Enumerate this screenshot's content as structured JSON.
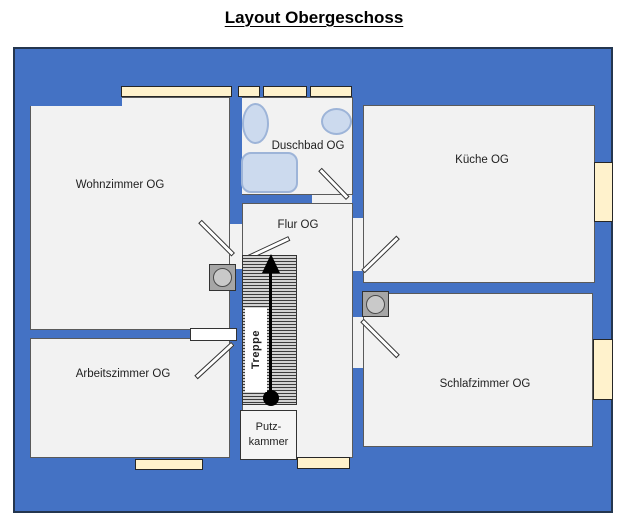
{
  "title": "Layout Obergeschoss",
  "rooms": {
    "wohnzimmer": {
      "label": "Wohnzimmer OG"
    },
    "duschbad": {
      "label": "Duschbad OG"
    },
    "kueche": {
      "label": "Küche OG"
    },
    "flur": {
      "label": "Flur OG"
    },
    "arbeitszimmer": {
      "label": "Arbeitszimmer OG"
    },
    "schlafzimmer": {
      "label": "Schlafzimmer OG"
    },
    "treppe": {
      "label": "Treppe"
    },
    "putzkammer": {
      "label": "Putz-\nkammer"
    }
  },
  "icons": {
    "stairs_direction": "up-arrow-icon",
    "columns": "chimney-column-icon",
    "doors": "door-leaf-icon",
    "windows": "window-icon"
  },
  "colors": {
    "blue": "#4472C4",
    "wall_border": "#24364F",
    "floor": "#F2F2F2",
    "floor_border": "#5A5A5A",
    "window_fill": "#FFF2CC",
    "window_border": "#262626",
    "fixture_fill": "#CCDAEE",
    "fixture_border": "#9DB4D8",
    "column_fill": "#A6A6A6",
    "ink": "#1F1F1F"
  }
}
